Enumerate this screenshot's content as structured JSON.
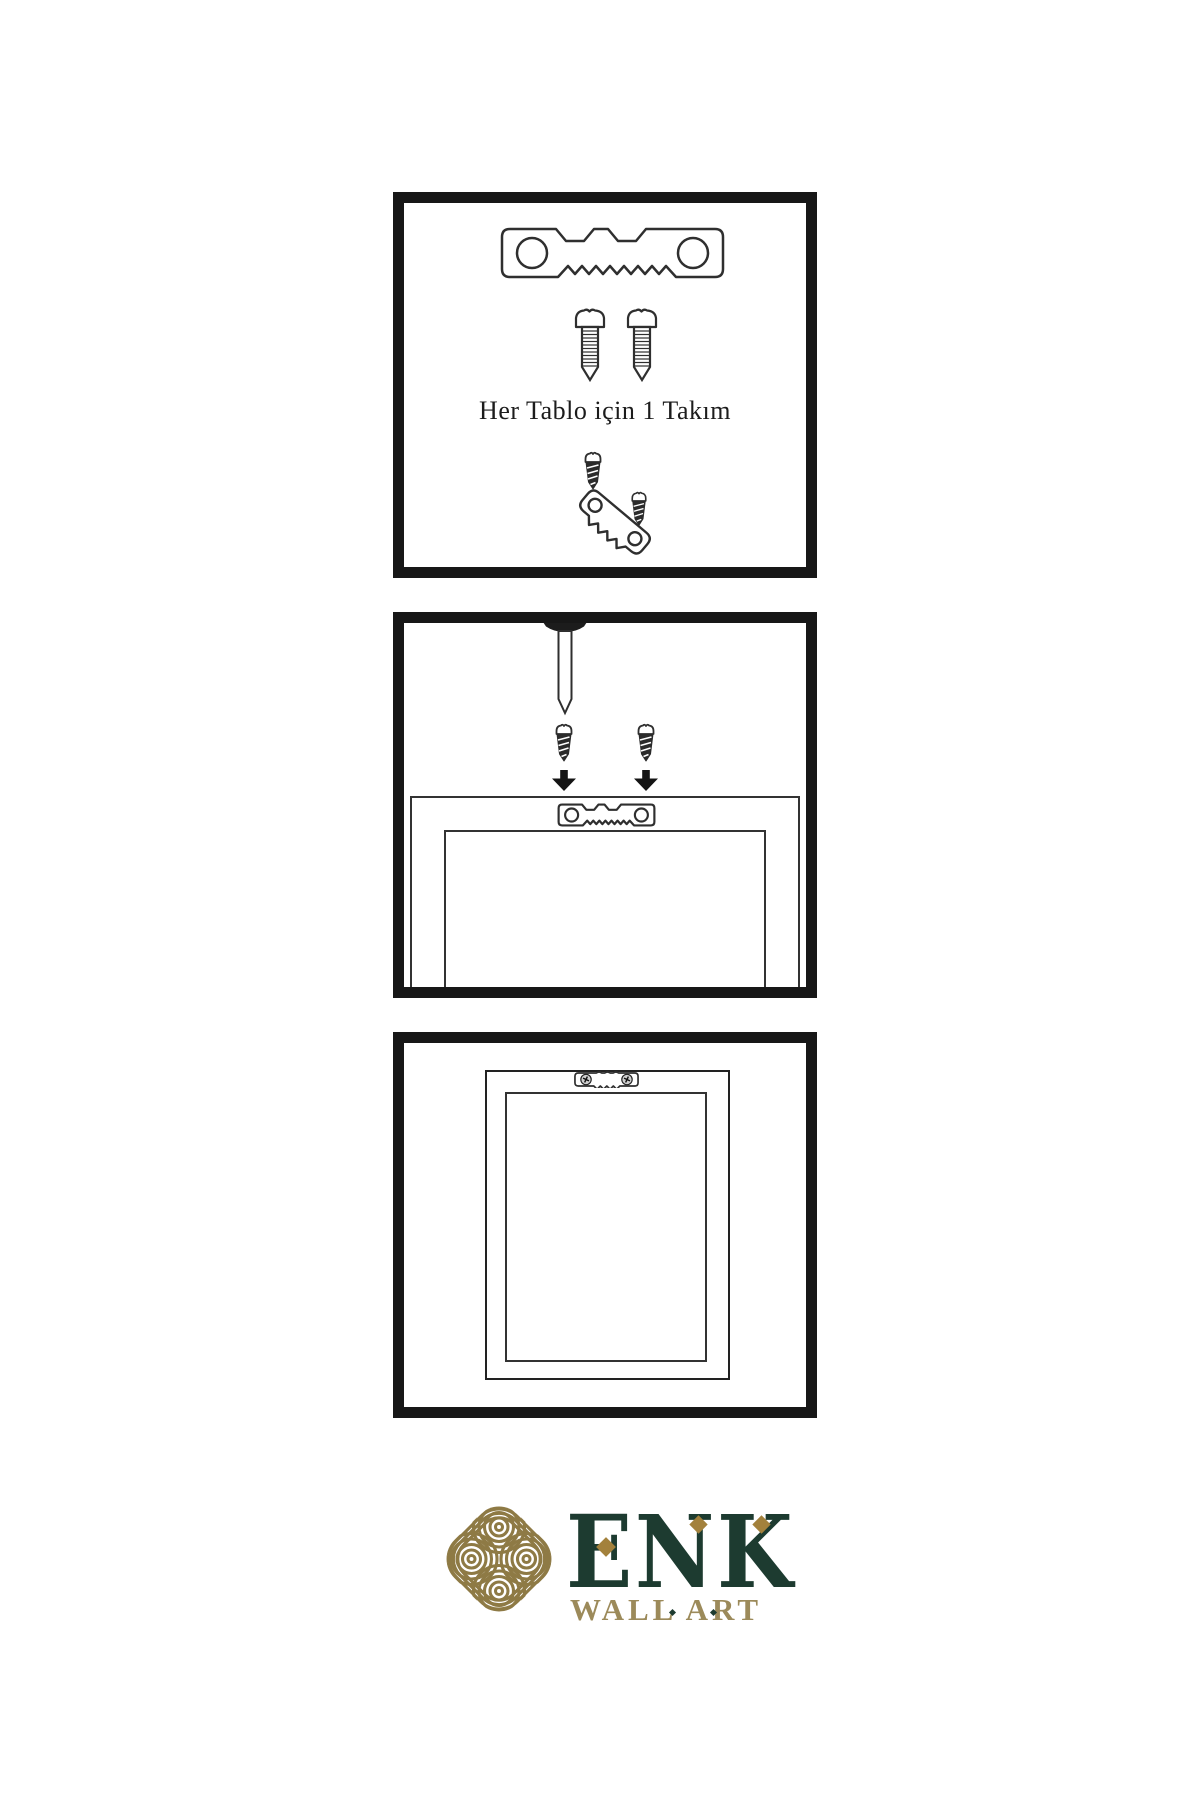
{
  "step1": {
    "caption": "Her Tablo için 1 Takım"
  },
  "brand": {
    "name": "ENK",
    "subtitle": "WALL ART"
  },
  "colors": {
    "panel_border": "#171717",
    "outline": "#2f2f2f",
    "dark_fill": "#262626",
    "brand_green": "#1d3b30",
    "knot_gold": "#8e7a45",
    "diamond_gold": "#a3813c",
    "subtitle_gold": "#9c8a5a"
  },
  "icons": {
    "step1": [
      "sawtooth-hanger-icon",
      "screw-icon",
      "screw-icon",
      "dark-screw-icon",
      "tilted-sawtooth-hanger-icon",
      "dark-screw-icon"
    ],
    "step2": [
      "nail-icon",
      "dark-screw-icon",
      "dark-screw-icon",
      "arrow-down-icon",
      "arrow-down-icon",
      "sawtooth-hanger-icon",
      "frame-back-view"
    ],
    "step3": [
      "sawtooth-hanger-with-screws-icon",
      "frame-front-view"
    ],
    "brand": [
      "knot-logo-icon"
    ]
  }
}
